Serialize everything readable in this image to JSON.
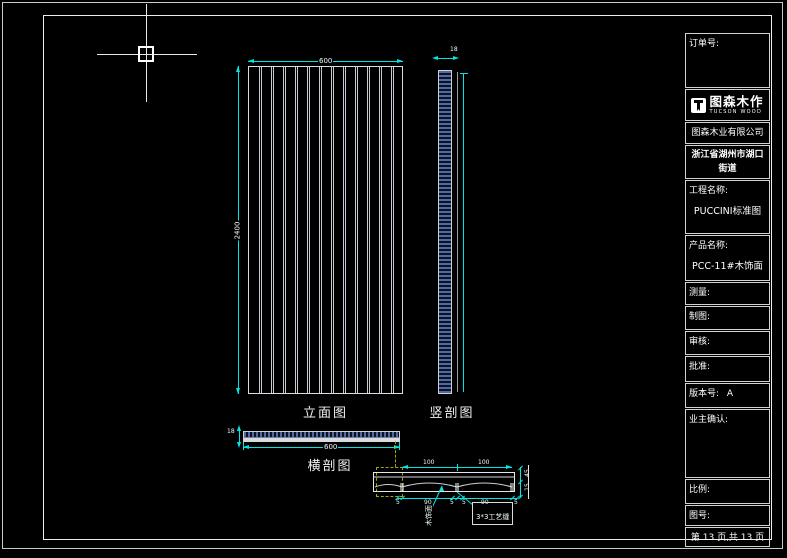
{
  "colors": {
    "background": "#000000",
    "frame": "#ececec",
    "dimension": "#00e5e5",
    "callout_dash": "#a8a400",
    "hatch_blue": "#50699f"
  },
  "titleblock": {
    "order_label": "订单号:",
    "logo": {
      "name": "图森木作",
      "sub": "TUCSON WOOD"
    },
    "company": "图森木业有限公司",
    "address_line1": "浙江省湖州市湖口街道",
    "address_line2": "城中路1号",
    "project_label": "工程名称:",
    "project_value": "PUCCINI标准图",
    "product_label": "产品名称:",
    "product_value": "PCC-11#木饰面",
    "measure_label": "测量:",
    "draft_label": "制图:",
    "review_label": "审核:",
    "approve_label": "批准:",
    "version_label": "版本号:",
    "version_value": "A",
    "owner_label": "业主确认:",
    "scale_label": "比例:",
    "dwgno_label": "图号:",
    "page_text": "第 13 页,共 13 页"
  },
  "drawings": {
    "elevation": {
      "label": "立面图",
      "width_dim": "600",
      "height_dim": "2400",
      "groove_count": 12
    },
    "vsection": {
      "label": "竖剖图",
      "thickness_dim": "18"
    },
    "hsection": {
      "label": "横剖图",
      "width_dim": "600",
      "thickness_dim": "18"
    },
    "detail": {
      "top_dims": [
        "100",
        "100"
      ],
      "bottom_dims": [
        "5",
        "90",
        "5",
        "5",
        "90",
        "5"
      ],
      "right_dims": [
        "45",
        "15"
      ],
      "groove_callout": "3*3工艺缝",
      "surface_label": "木饰面"
    }
  }
}
